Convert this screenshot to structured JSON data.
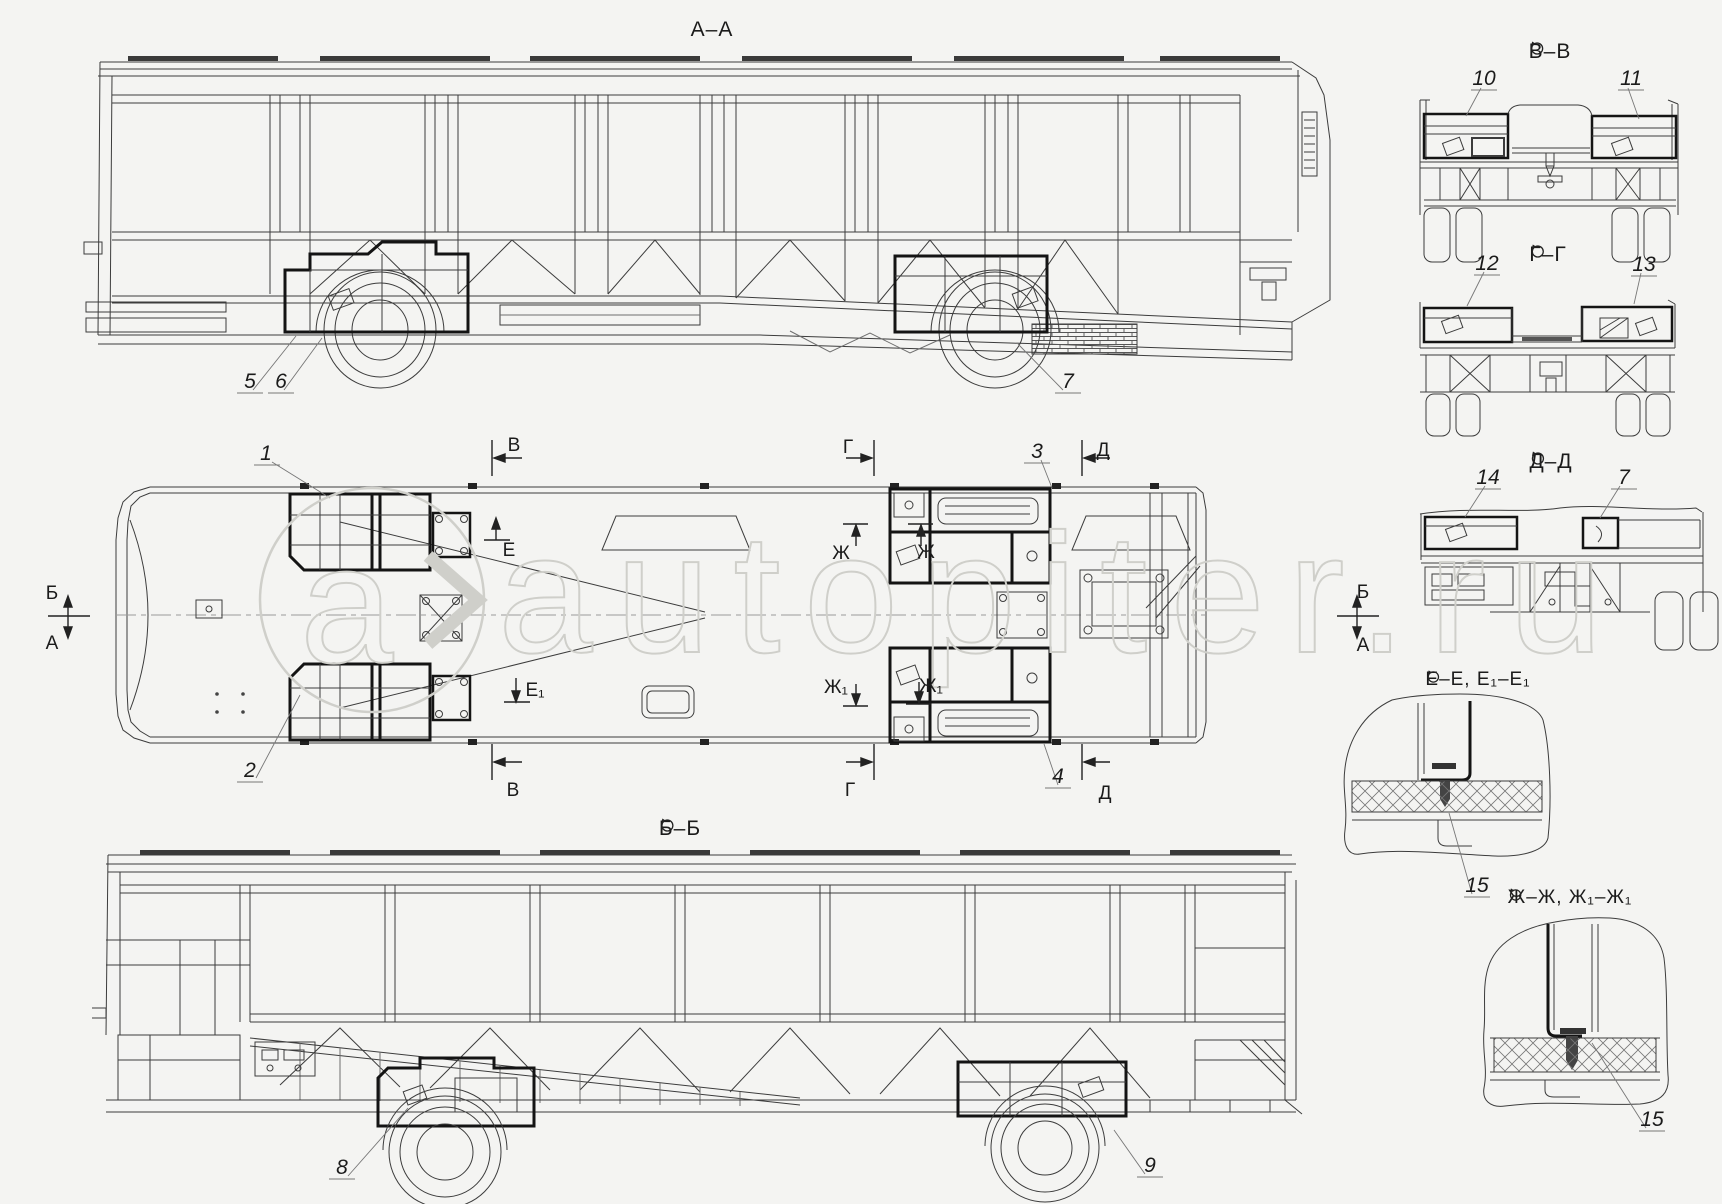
{
  "document": {
    "type": "technical-assembly-drawing",
    "subject": "bus body frame and floor assembly, orthographic views"
  },
  "colors": {
    "background": "#f4f4f2",
    "line": "#3c3c3c",
    "bold_line": "#141414",
    "watermark": "#cfcfca"
  },
  "watermark": {
    "text": "autopiter.ru",
    "logo_letter": "a"
  },
  "titles": {
    "aa": "А–А",
    "bb": "Б–Б",
    "vv": "В–В",
    "gg": "Г–Г",
    "dd": "Д–Д",
    "ee": "Е–Е, Е₁–Е₁",
    "zh": "Ж–Ж, Ж₁–Ж₁"
  },
  "callouts": {
    "c1": "1",
    "c2": "2",
    "c3": "3",
    "c4": "4",
    "c5": "5",
    "c6": "6",
    "c7": "7",
    "c7b": "7",
    "c8": "8",
    "c9": "9",
    "c10": "10",
    "c11": "11",
    "c12": "12",
    "c13": "13",
    "c14": "14",
    "c15a": "15",
    "c15b": "15"
  },
  "markers": {
    "b_left": "Б",
    "a_left": "А",
    "b_right": "Б",
    "a_right": "А",
    "v_top": "В",
    "v_bottom": "В",
    "g_top": "Г",
    "g_bottom": "Г",
    "d_top": "Д",
    "d_bottom": "Д",
    "e": "Е",
    "e1": "Е₁",
    "zh_a": "Ж",
    "zh_b": "Ж",
    "zh1_a": "Ж₁",
    "zh1_b": "Ж₁"
  }
}
